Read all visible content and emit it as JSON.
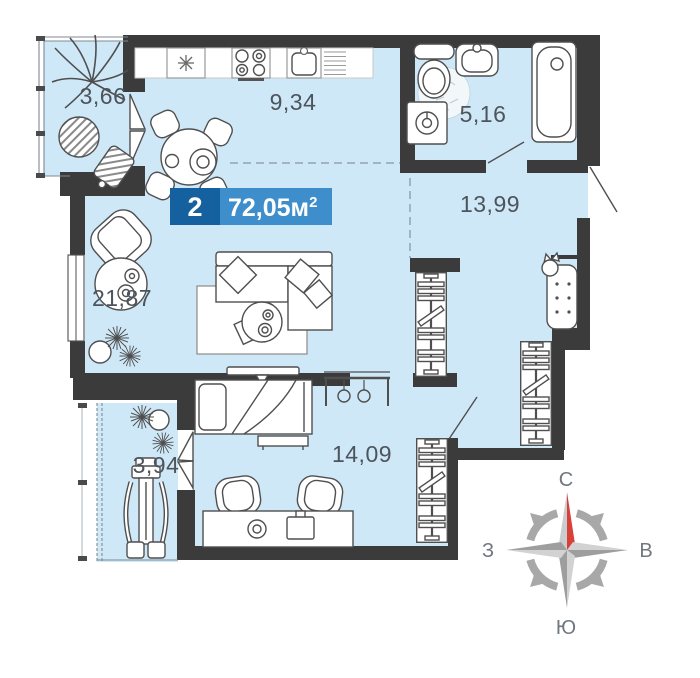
{
  "floor_plan": {
    "badge": {
      "room_count": "2",
      "area_text": "72,05м",
      "area_superscript": "2"
    },
    "room_areas": {
      "balcony_top": "3,66",
      "kitchen": "9,34",
      "bathroom": "5,16",
      "hallway": "13,99",
      "living_room": "21,87",
      "bedroom": "14,09",
      "balcony_bottom": "3,94"
    },
    "compass": {
      "north_label": "С",
      "east_label": "В",
      "west_label": "З",
      "south_label": "Ю"
    },
    "colors": {
      "floor_blue": "#cfe8f8",
      "wall_dark": "#3b3b3b",
      "badge_dark_blue": "#15619f",
      "badge_light_blue": "#3e8ecb",
      "compass_red": "#d84038"
    }
  }
}
